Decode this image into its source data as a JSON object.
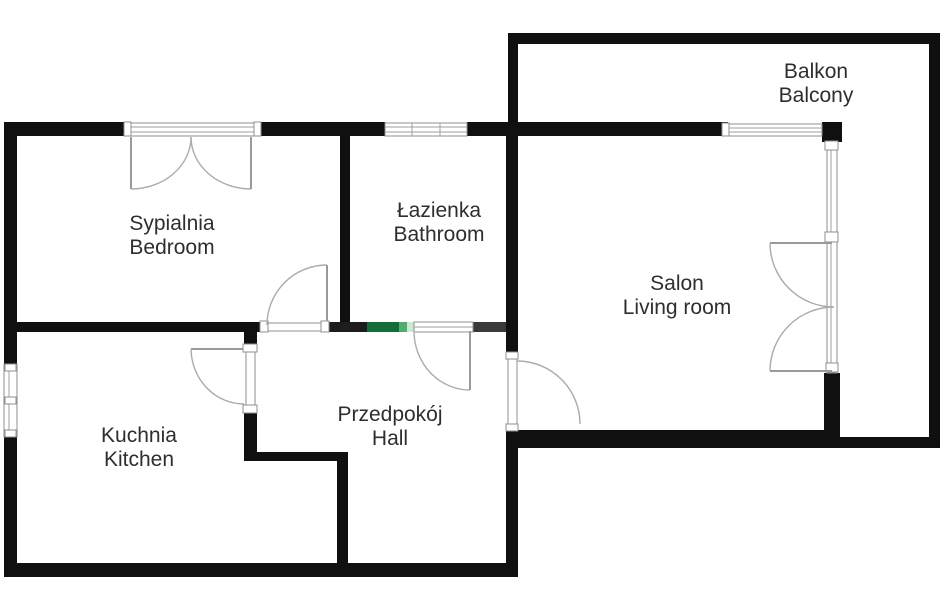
{
  "rooms": [
    {
      "id": "bedroom",
      "label_pl": "Sypialnia",
      "label_en": "Bedroom"
    },
    {
      "id": "bathroom",
      "label_pl": "Łazienka",
      "label_en": "Bathroom"
    },
    {
      "id": "balcony",
      "label_pl": "Balkon",
      "label_en": "Balcony"
    },
    {
      "id": "living_room",
      "label_pl": "Salon",
      "label_en": "Living room"
    },
    {
      "id": "kitchen",
      "label_pl": "Kuchnia",
      "label_en": "Kitchen"
    },
    {
      "id": "hall",
      "label_pl": "Przedpokój",
      "label_en": "Hall"
    }
  ],
  "colors": {
    "wall": "#101010",
    "wall_shaded": "#3a3a3a",
    "brand_green_dark": "#156e38",
    "brand_green_mid": "#4fae6e",
    "brand_green_light": "#c8ead2",
    "text": "#2e2e2e",
    "background": "#ffffff"
  }
}
